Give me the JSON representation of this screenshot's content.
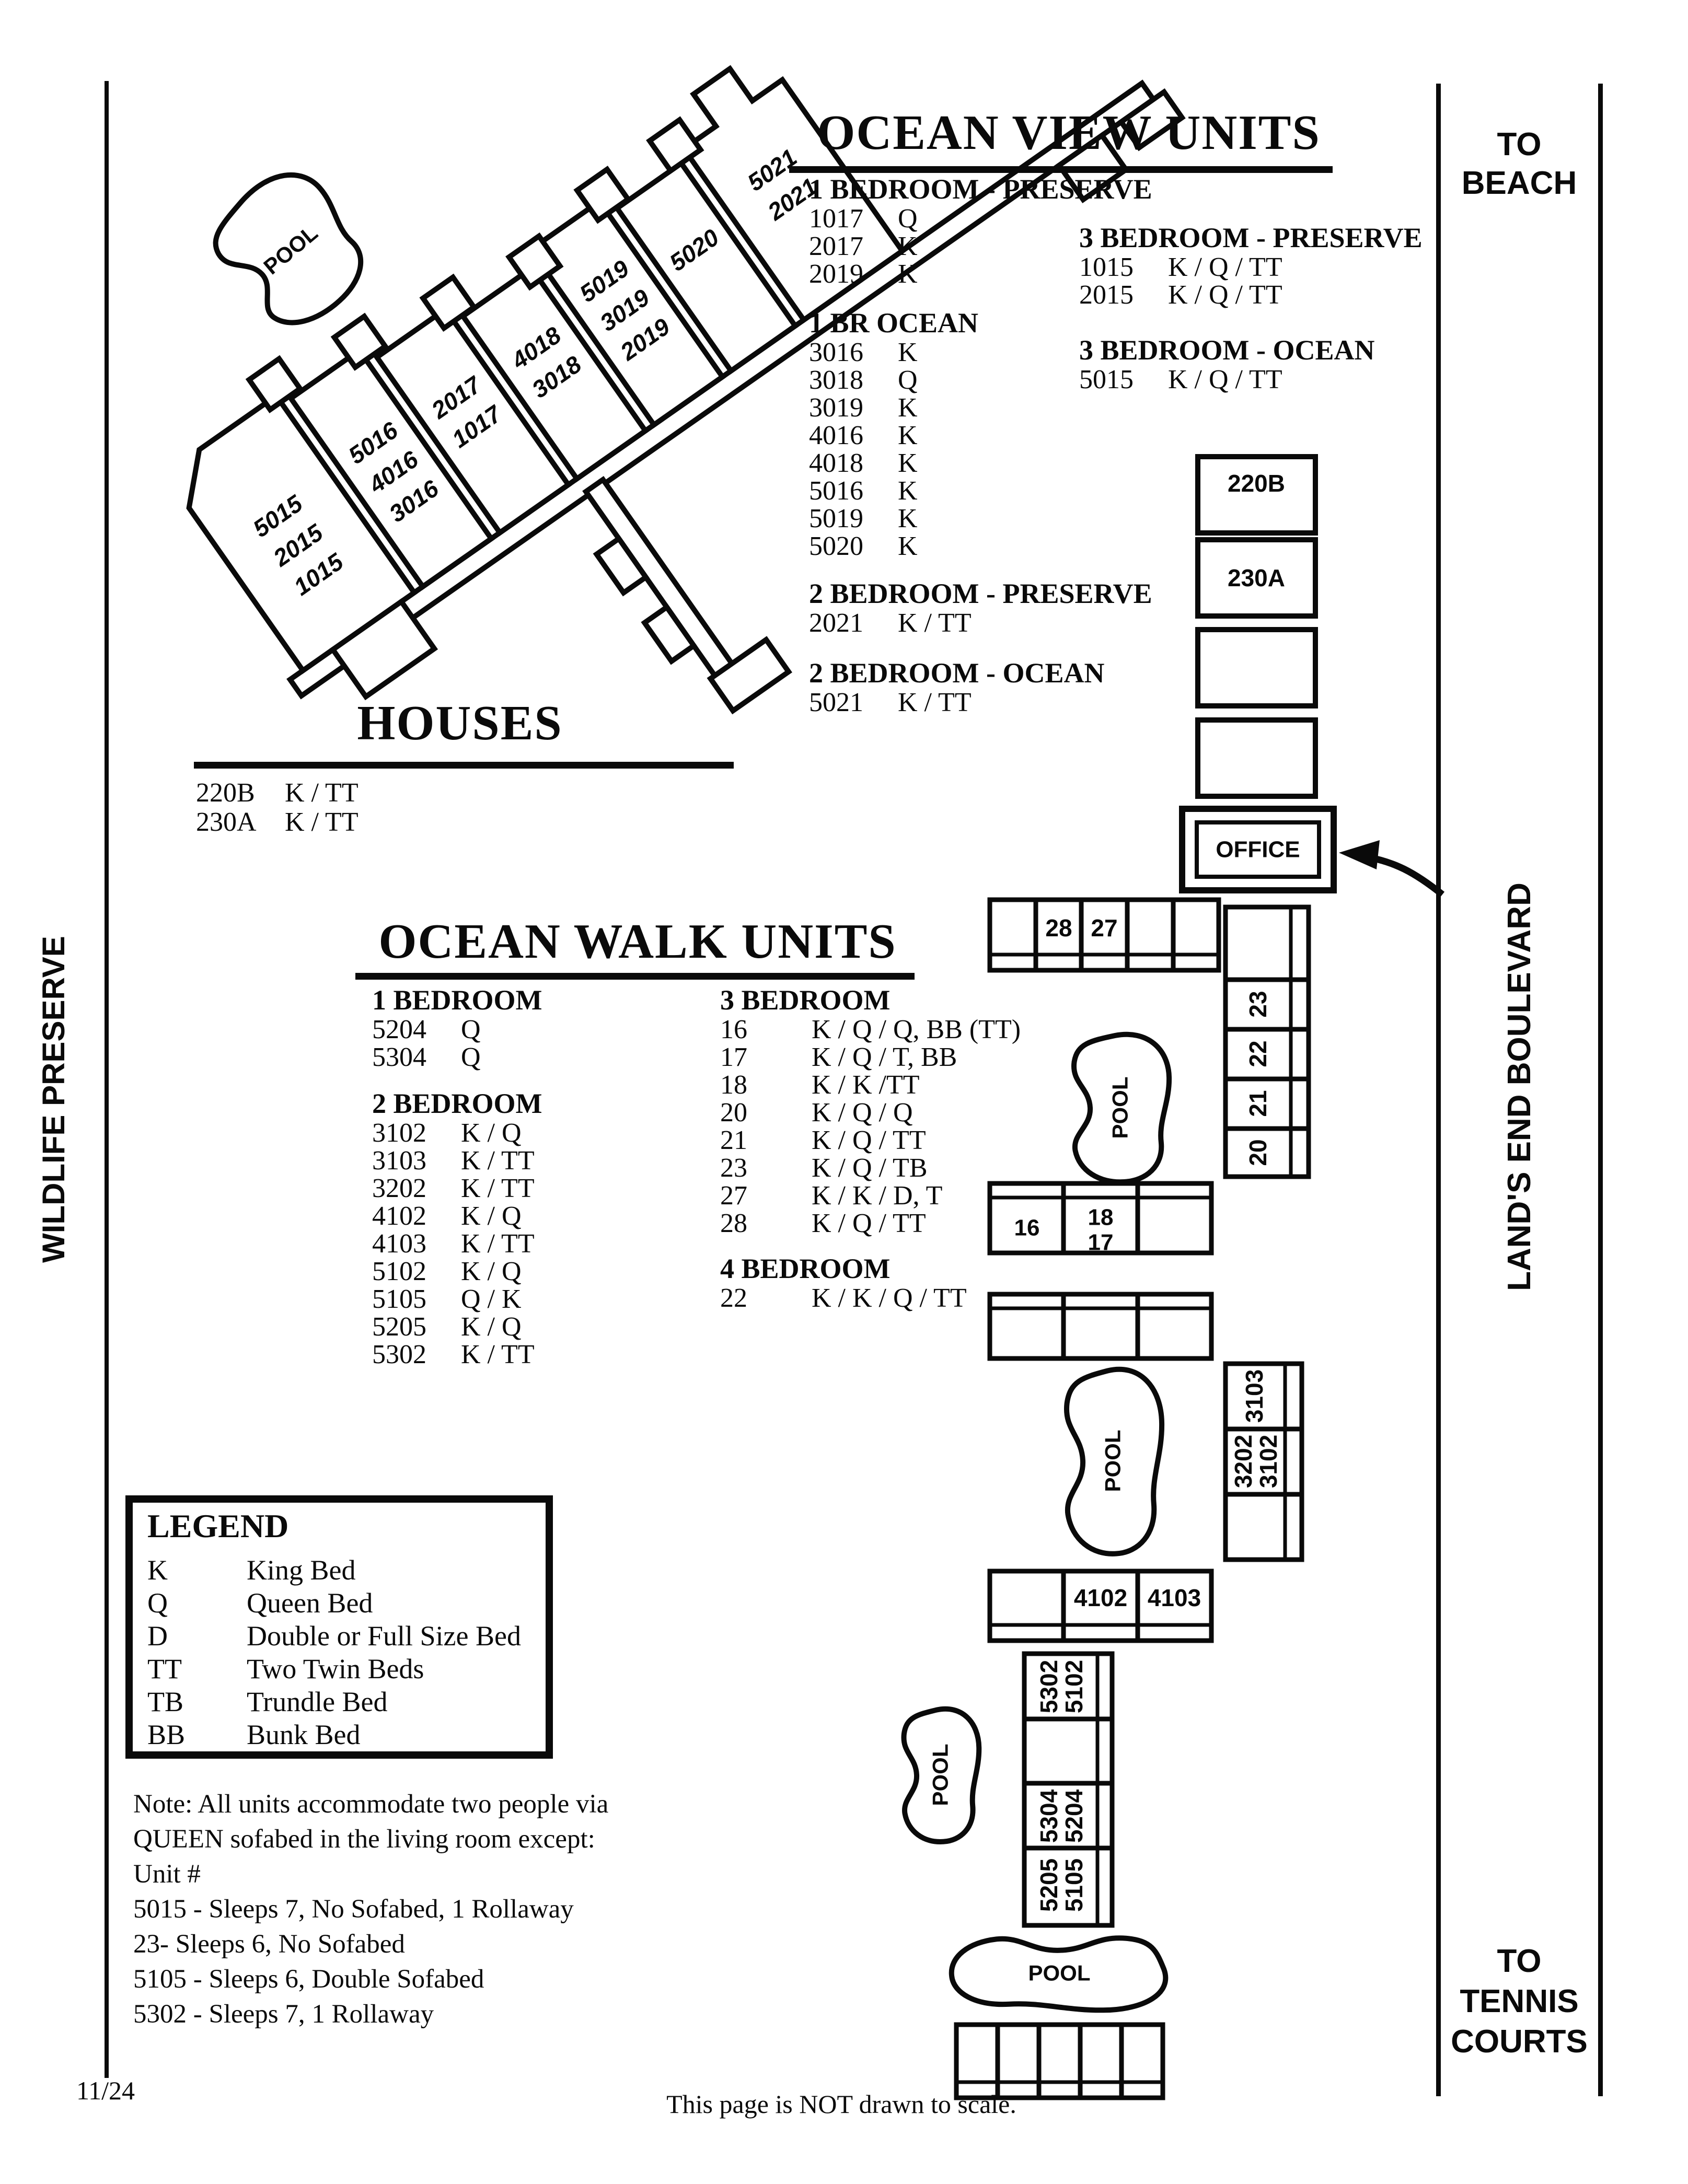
{
  "ocean_view": {
    "title": "OCEAN VIEW UNITS",
    "groups": [
      {
        "heading": "1 BEDROOM - PRESERVE",
        "rows": [
          [
            "1017",
            "Q"
          ],
          [
            "2017",
            "K"
          ],
          [
            "2019",
            "K"
          ]
        ]
      },
      {
        "heading": "1 BR OCEAN",
        "rows": [
          [
            "3016",
            "K"
          ],
          [
            "3018",
            "Q"
          ],
          [
            "3019",
            "K"
          ],
          [
            "4016",
            "K"
          ],
          [
            "4018",
            "K"
          ],
          [
            "5016",
            "K"
          ],
          [
            "5019",
            "K"
          ],
          [
            "5020",
            "K"
          ]
        ]
      },
      {
        "heading": "2 BEDROOM - PRESERVE",
        "rows": [
          [
            "2021",
            "K / TT"
          ]
        ]
      },
      {
        "heading": "2 BEDROOM - OCEAN",
        "rows": [
          [
            "5021",
            "K / TT"
          ]
        ]
      },
      {
        "heading": "3 BEDROOM - PRESERVE",
        "rows": [
          [
            "1015",
            "K / Q / TT"
          ],
          [
            "2015",
            "K / Q / TT"
          ]
        ]
      },
      {
        "heading": "3 BEDROOM - OCEAN",
        "rows": [
          [
            "5015",
            "K / Q / TT"
          ]
        ]
      }
    ]
  },
  "houses_section": {
    "title": "HOUSES",
    "rows": [
      [
        "220B",
        "K / TT"
      ],
      [
        "230A",
        "K / TT"
      ]
    ]
  },
  "ocean_walk": {
    "title": "OCEAN WALK UNITS",
    "groups": [
      {
        "heading": "1 BEDROOM",
        "rows": [
          [
            "5204",
            "Q"
          ],
          [
            "5304",
            "Q"
          ]
        ]
      },
      {
        "heading": "2 BEDROOM",
        "rows": [
          [
            "3102",
            "K / Q"
          ],
          [
            "3103",
            "K / TT"
          ],
          [
            "3202",
            "K / TT"
          ],
          [
            "4102",
            "K / Q"
          ],
          [
            "4103",
            "K / TT"
          ],
          [
            "5102",
            "K / Q"
          ],
          [
            "5105",
            "Q / K"
          ],
          [
            "5205",
            "K / Q"
          ],
          [
            "5302",
            "K / TT"
          ]
        ]
      },
      {
        "heading": "3 BEDROOM",
        "rows": [
          [
            "16",
            "K / Q / Q, BB (TT)"
          ],
          [
            "17",
            "K / Q / T, BB"
          ],
          [
            "18",
            "K / K /TT"
          ],
          [
            "20",
            "K / Q / Q"
          ],
          [
            "21",
            "K / Q / TT"
          ],
          [
            "23",
            "K / Q / TB"
          ],
          [
            "27",
            "K / K / D, T"
          ],
          [
            "28",
            "K / Q / TT"
          ]
        ]
      },
      {
        "heading": "4 BEDROOM",
        "rows": [
          [
            "22",
            "K / K / Q / TT"
          ]
        ]
      }
    ]
  },
  "legend": {
    "title": "LEGEND",
    "entries": [
      [
        "K",
        "King Bed"
      ],
      [
        "Q",
        "Queen Bed"
      ],
      [
        "D",
        "Double or Full Size Bed"
      ],
      [
        "TT",
        "Two Twin Beds"
      ],
      [
        "TB",
        "Trundle Bed"
      ],
      [
        "BB",
        "Bunk Bed"
      ]
    ]
  },
  "note": {
    "lines": [
      "Note: All units accommodate two people via",
      "QUEEN sofabed in the living room except:",
      "Unit #",
      "5015 - Sleeps 7, No Sofabed, 1 Rollaway",
      "23- Sleeps 6, No Sofabed",
      "5105 - Sleeps 6, Double Sofabed",
      "5302 - Sleeps 7, 1 Rollaway"
    ]
  },
  "side_label": "WILDLIFE PRESERVE",
  "road": {
    "to_beach": [
      "TO",
      "BEACH"
    ],
    "name": "LAND'S END BOULEVARD",
    "to_tennis": [
      "TO",
      "TENNIS",
      "COURTS"
    ]
  },
  "footer": {
    "date": "11/24",
    "caption": "This page is NOT drawn to scale."
  },
  "map": {
    "pool": "POOL",
    "office": "OFFICE",
    "box_220b": "220B",
    "box_230a": "230A",
    "row_top": {
      "c28": "28",
      "c27": "27"
    },
    "mid": {
      "c16": "16",
      "c18": "18",
      "c17": "17"
    },
    "col_right": {
      "c23": "23",
      "c22": "22",
      "c21": "21",
      "c20": "20"
    },
    "e": {
      "t": "3103",
      "m1": "3202",
      "m2": "3102"
    },
    "f": {
      "a": "4102",
      "b": "4103"
    },
    "g": {
      "a1": "5302",
      "a2": "5102",
      "b1": "5304",
      "b2": "5204",
      "c1": "5205",
      "c2": "5105"
    },
    "houses": {
      "b1": [
        "5015",
        "2015",
        "1015"
      ],
      "b2": [
        "5016",
        "4016",
        "3016"
      ],
      "b3": [
        "2017",
        "1017"
      ],
      "b4": [
        "4018",
        "3018"
      ],
      "b5": [
        "5019",
        "3019",
        "2019"
      ],
      "b6": [
        "5020"
      ],
      "b7": [
        "5021",
        "2021"
      ]
    }
  }
}
